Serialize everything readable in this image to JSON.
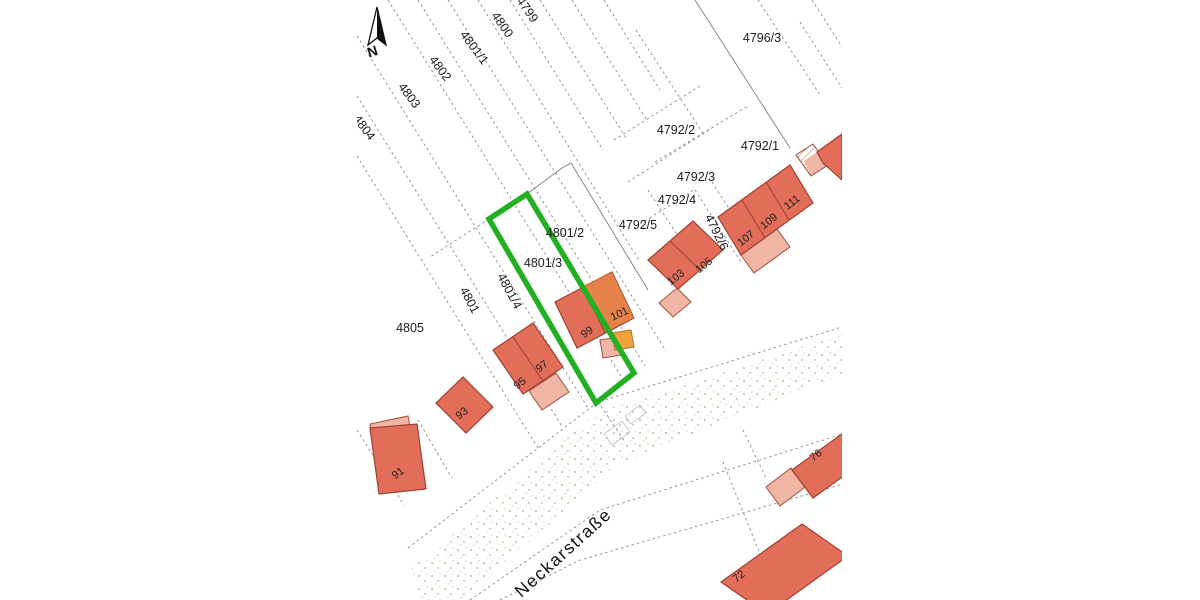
{
  "map": {
    "type": "cadastral-parcel-map",
    "street_name": "Neckarstraße",
    "north_label": "N",
    "highlighted_parcel": "4801/3",
    "colors": {
      "highlight_green": "#22b022",
      "building_fill": "#e26e59",
      "building_outline": "#9e4032",
      "annex_fill": "#f0b5a4",
      "accent_orange": "#eda23f",
      "boundary_line": "#8a8a8a"
    },
    "parcels": {
      "p4799": "4799",
      "p4800": "4800",
      "p4801_1": "4801/1",
      "p4802": "4802",
      "p4803": "4803",
      "p4804": "4804",
      "p4805": "4805",
      "p4801": "4801",
      "p4801_4": "4801/4",
      "p4801_3": "4801/3",
      "p4801_2": "4801/2",
      "p4796_3": "4796/3",
      "p4792_1": "4792/1",
      "p4792_2": "4792/2",
      "p4792_3": "4792/3",
      "p4792_4": "4792/4",
      "p4792_5": "4792/5",
      "p4792_6": "4792/6"
    },
    "house_numbers": {
      "h91": "91",
      "h93": "93",
      "h95": "95",
      "h97": "97",
      "h99": "99",
      "h101": "101",
      "h103": "103",
      "h105": "105",
      "h107": "107",
      "h109": "109",
      "h111": "111",
      "h72": "72",
      "h76": "76"
    }
  }
}
